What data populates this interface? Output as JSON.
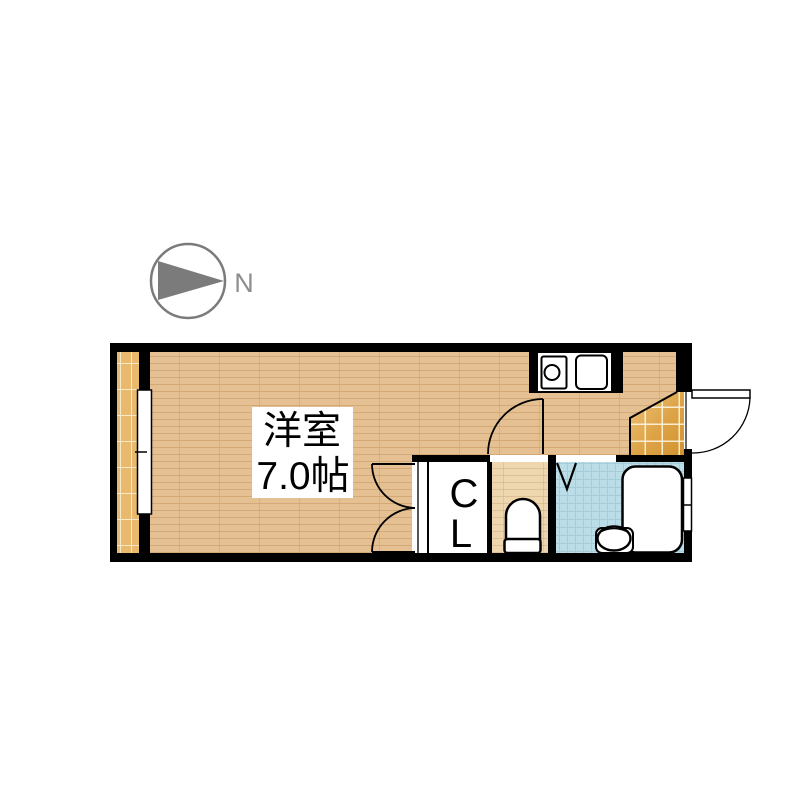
{
  "compass": {
    "label": "N"
  },
  "rooms": {
    "western_room": {
      "name": "洋室",
      "size": "7.0帖"
    },
    "closet": {
      "line1": "C",
      "line2": "L"
    }
  },
  "icons": {
    "north_arrow": "gray triangle in circle pointing right",
    "stove": "single burner circle in square",
    "sink": "rounded square basin",
    "toilet": "bowl with tank",
    "bathtub": "rounded rectangle tub",
    "wash_basin": "oval bowl",
    "doors": "quarter-circle swing arcs, V fold door, sliding closet panel"
  },
  "colors": {
    "wall": "#000000",
    "wood_floor": "#e5c093",
    "toilet_floor": "#eed6ae",
    "balcony_tile": "#e9ba6e",
    "entry_tile": "#d2932f",
    "bath_tile": "#badde7",
    "compass_gray": "#7b7b7b"
  }
}
